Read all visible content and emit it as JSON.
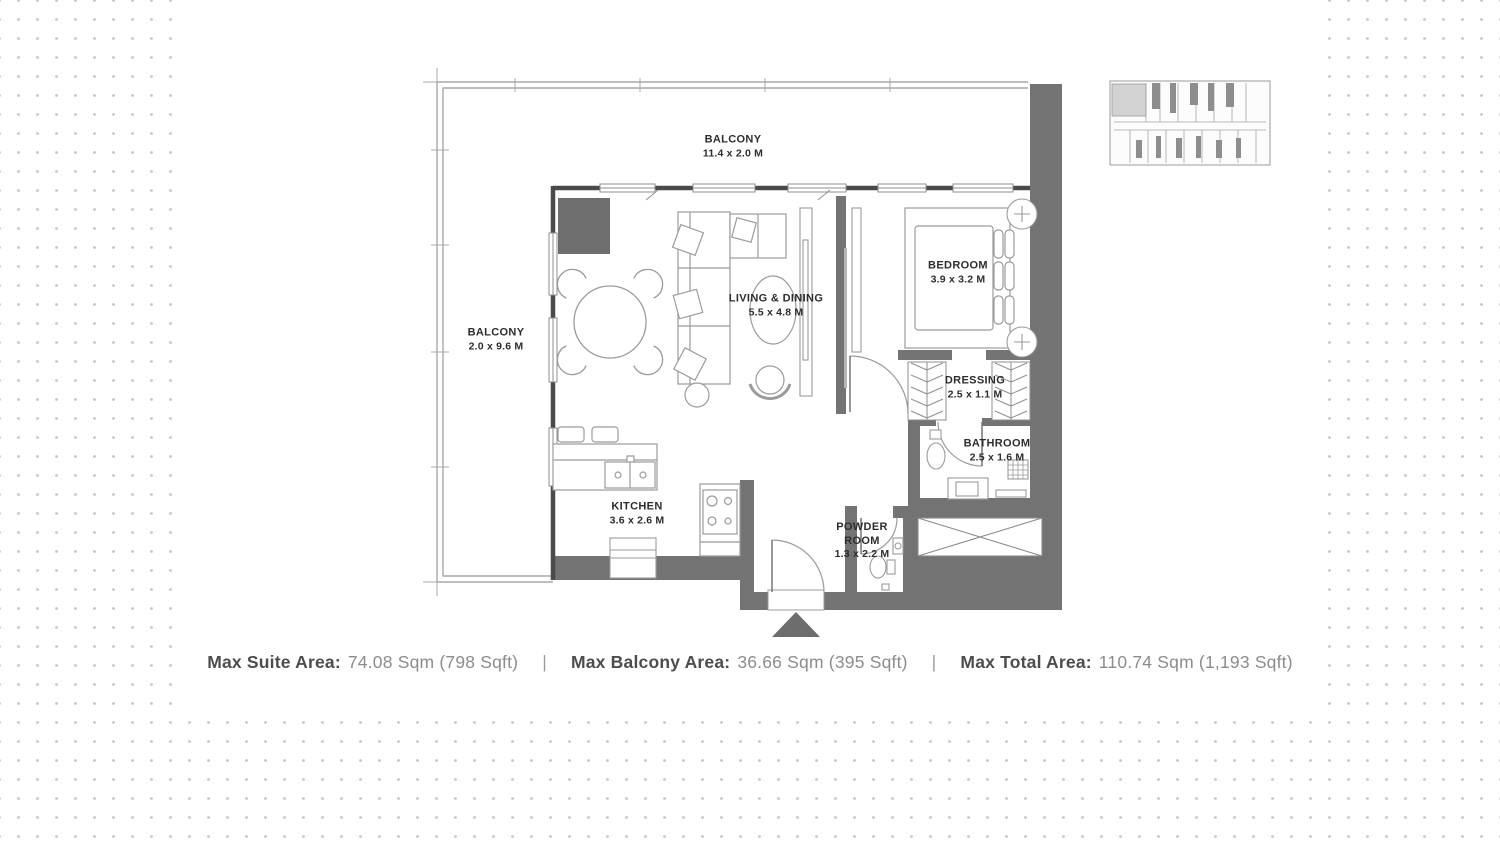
{
  "plan": {
    "rooms": {
      "balcony_top": {
        "name": "BALCONY",
        "dims": "11.4 x 2.0 M"
      },
      "balcony_left": {
        "name": "BALCONY",
        "dims": "2.0 x 9.6 M"
      },
      "living_dining": {
        "name": "LIVING & DINING",
        "dims": "5.5 x 4.8 M"
      },
      "bedroom": {
        "name": "BEDROOM",
        "dims": "3.9 x 3.2 M"
      },
      "dressing": {
        "name": "DRESSING",
        "dims": "2.5 x 1.1 M"
      },
      "bathroom": {
        "name": "BATHROOM",
        "dims": "2.5 x 1.6 M"
      },
      "kitchen": {
        "name": "KITCHEN",
        "dims": "3.6 x 2.6 M"
      },
      "powder_room": {
        "name_line1": "POWDER",
        "name_line2": "ROOM",
        "dims": "1.3 x 2.2 M"
      }
    },
    "colors": {
      "thick_wall": "#737373",
      "thin_wall": "#4a4a4a",
      "furniture_line": "#9b9b9b",
      "label_text": "#2d2d2d",
      "dot_grid": "#c6c6c6"
    }
  },
  "key_plan": {
    "highlight_color": "#d2d2d2"
  },
  "summary": {
    "separator": "|",
    "items": [
      {
        "label": "Max Suite Area:",
        "value": "74.08 Sqm (798 Sqft)"
      },
      {
        "label": "Max Balcony Area:",
        "value": "36.66 Sqm (395 Sqft)"
      },
      {
        "label": "Max Total Area:",
        "value": "110.74 Sqm (1,193 Sqft)"
      }
    ]
  }
}
